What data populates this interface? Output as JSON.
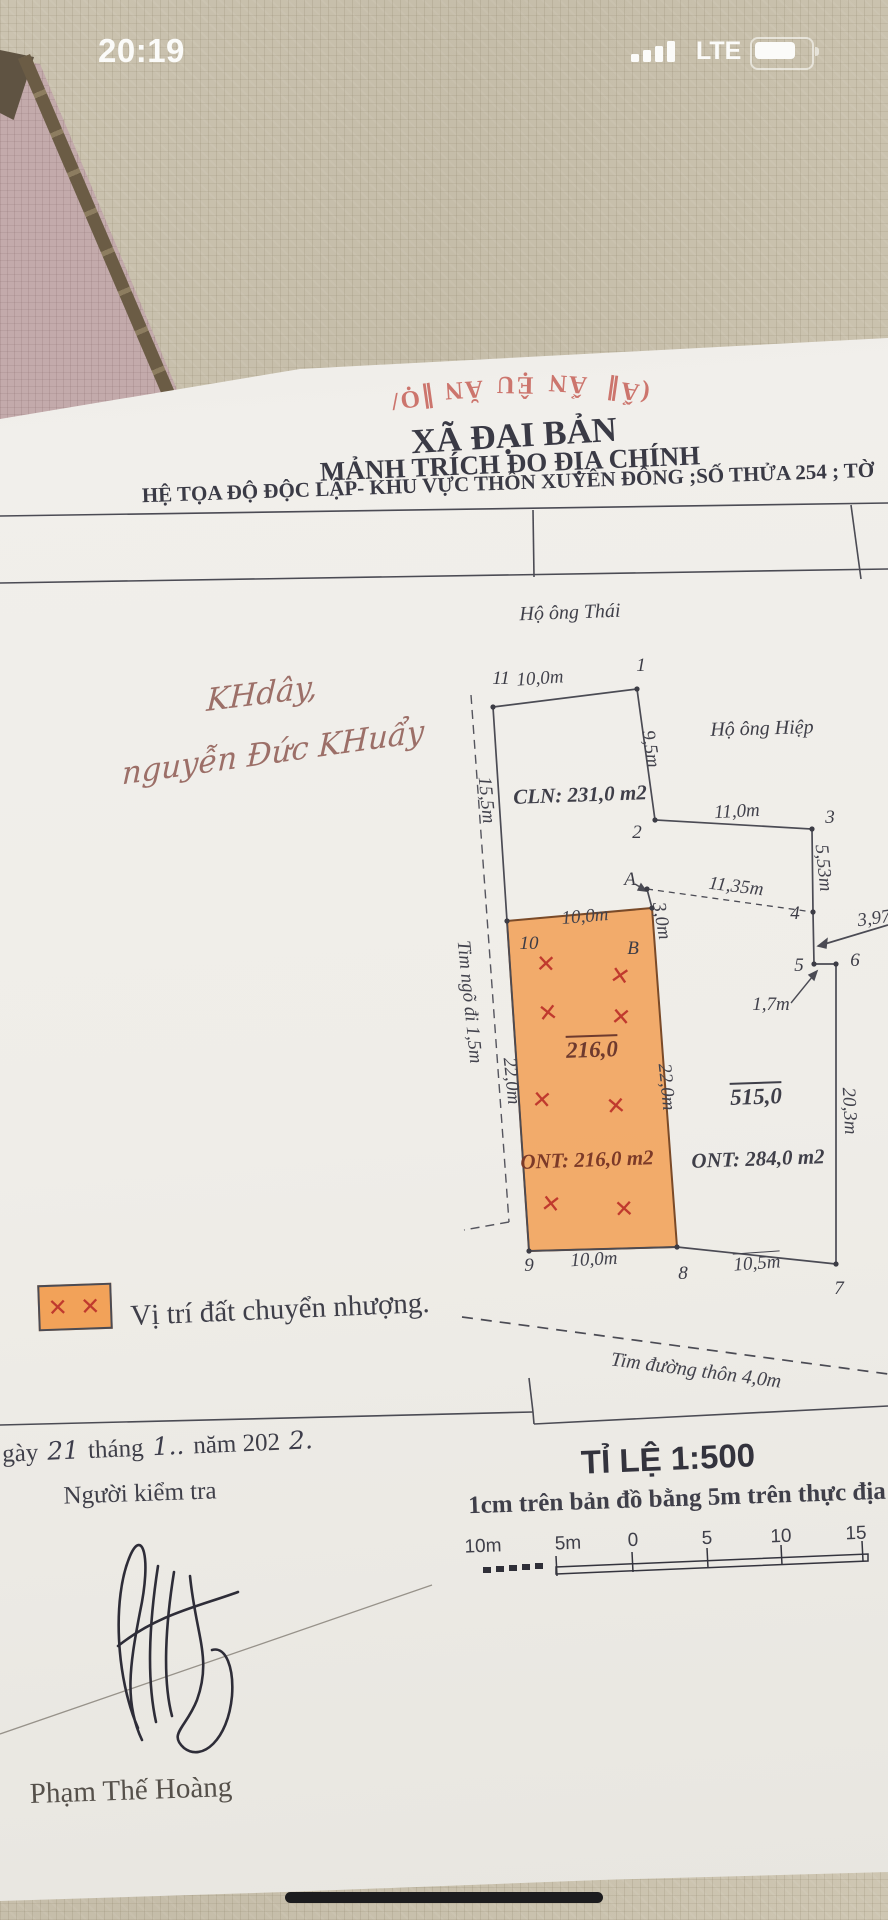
{
  "status_bar": {
    "time": "20:19",
    "network": "LTE"
  },
  "colors": {
    "plot_fill": "#F2A259",
    "mark_red": "#C03A2E",
    "stamp_red": "#C4574E"
  },
  "stamp_fragments": [
    "∥Ọ/",
    "ĂN",
    "ỆU",
    "ẨN",
    "(Ẩ∥"
  ],
  "header": {
    "commune": "XÃ ĐẠI BẢN",
    "title": "MẢNH TRÍCH ĐO ĐỊA CHÍNH",
    "subtitle": "HỆ TỌA ĐỘ ĐỘC LẬP- KHU VỰC THÔN XUYÊN ĐÔNG ;SỐ THỬA 254 ; TỜ"
  },
  "note": {
    "line1": "KHdây,",
    "line2": "nguyễn Đức KHuẩy"
  },
  "diagram": {
    "neighbor_top": "Hộ ông Thái",
    "neighbor_right": "Hộ ông Hiệp",
    "cln": "CLN: 231,0 m2",
    "points": {
      "p11": "11",
      "p1": "1",
      "p2": "2",
      "p3": "3",
      "p4": "4",
      "p5": "5",
      "p6": "6",
      "p7": "7",
      "p8": "8",
      "p9": "9",
      "p10": "10",
      "pA": "A",
      "pB": "B"
    },
    "dims": {
      "top": "10,0m",
      "e12": "9,5m",
      "e23": "11,0m",
      "e34": "5,53m",
      "a4": "11,35m",
      "a_b": "3,0m",
      "off": "3,97",
      "e56": "1,7m",
      "w": "15,5m",
      "wl": "22,0m",
      "wr": "22,0m",
      "er": "20,3m",
      "ot": "10,0m",
      "ob": "10,0m",
      "b87": "10,5m"
    },
    "area216": "216,0",
    "ont216": "ONT: 216,0 m2",
    "area515": "515,0",
    "ont284": "ONT: 284,0 m2",
    "alley": "Tim ngõ đi 1,5m",
    "road": "Tim đường thôn 4,0m",
    "mark": "✕"
  },
  "legend": {
    "marks": "✕ ✕",
    "label": "Vị trí đất chuyển nhượng."
  },
  "footer": {
    "date_prefix": "gày",
    "date_day": "21",
    "date_thang": "tháng",
    "date_month": "1..",
    "date_nam": "năm 202",
    "date_year": "2.",
    "inspector": "Người kiểm tra",
    "scale_title": "TỈ LỆ 1:500",
    "scale_caption": "1cm trên bản đồ bằng 5m trên thực địa",
    "scale_ticks": [
      "10m",
      "5m",
      "0",
      "5",
      "10",
      "15"
    ],
    "signer": "Phạm Thế Hoàng"
  }
}
